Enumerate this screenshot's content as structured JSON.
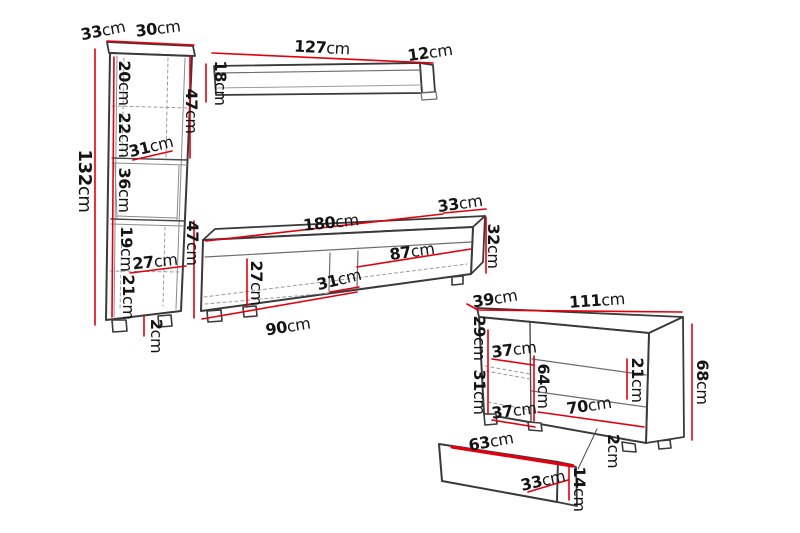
{
  "diagram": {
    "kind": "furniture dimension drawing",
    "unit": "cm"
  },
  "colors": {
    "dimension_line": "#e2000f",
    "outline": "#3a3a3a",
    "hidden_line": "#9b9b9b",
    "text": "#141414",
    "background": "#ffffff"
  },
  "pieces": {
    "tall_cabinet": {
      "name": "tall display cabinet",
      "dims": {
        "depth": {
          "v": "33",
          "u": "cm"
        },
        "width": {
          "v": "30",
          "u": "cm"
        },
        "height": {
          "v": "132",
          "u": "cm"
        },
        "section1": {
          "v": "20",
          "u": "cm"
        },
        "section2": {
          "v": "22",
          "u": "cm"
        },
        "niche_width": {
          "v": "31",
          "u": "cm"
        },
        "section3": {
          "v": "36",
          "u": "cm"
        },
        "section4": {
          "v": "19",
          "u": "cm"
        },
        "inner_width": {
          "v": "27",
          "u": "cm"
        },
        "section5": {
          "v": "21",
          "u": "cm"
        },
        "plinth": {
          "v": "2",
          "u": "cm"
        },
        "upper_door": {
          "v": "47",
          "u": "cm"
        },
        "lower_door": {
          "v": "47",
          "u": "cm"
        }
      }
    },
    "wall_shelf": {
      "name": "wall shelf",
      "dims": {
        "width": {
          "v": "127",
          "u": "cm"
        },
        "depth": {
          "v": "12",
          "u": "cm"
        },
        "height": {
          "v": "18",
          "u": "cm"
        }
      }
    },
    "tv_stand": {
      "name": "tv stand",
      "dims": {
        "width": {
          "v": "180",
          "u": "cm"
        },
        "depth": {
          "v": "33",
          "u": "cm"
        },
        "height": {
          "v": "32",
          "u": "cm"
        },
        "right_section": {
          "v": "87",
          "u": "cm"
        },
        "inner_height": {
          "v": "27",
          "u": "cm"
        },
        "mid_section": {
          "v": "31",
          "u": "cm"
        },
        "left_section": {
          "v": "90",
          "u": "cm"
        }
      }
    },
    "sideboard": {
      "name": "sideboard",
      "dims": {
        "depth": {
          "v": "39",
          "u": "cm"
        },
        "width": {
          "v": "111",
          "u": "cm"
        },
        "height": {
          "v": "68",
          "u": "cm"
        },
        "upper_left": {
          "v": "29",
          "u": "cm"
        },
        "upper_shelf": {
          "v": "37",
          "u": "cm"
        },
        "inner_height": {
          "v": "64",
          "u": "cm"
        },
        "drawer_front": {
          "v": "21",
          "u": "cm"
        },
        "lower_left": {
          "v": "31",
          "u": "cm"
        },
        "lower_shelf": {
          "v": "37",
          "u": "cm"
        },
        "inner_width": {
          "v": "70",
          "u": "cm"
        },
        "plinth": {
          "v": "2",
          "u": "cm"
        }
      }
    },
    "drawer": {
      "name": "pull-out drawer",
      "dims": {
        "width": {
          "v": "63",
          "u": "cm"
        },
        "inner_width": {
          "v": "33",
          "u": "cm"
        },
        "height": {
          "v": "14",
          "u": "cm"
        }
      }
    }
  }
}
